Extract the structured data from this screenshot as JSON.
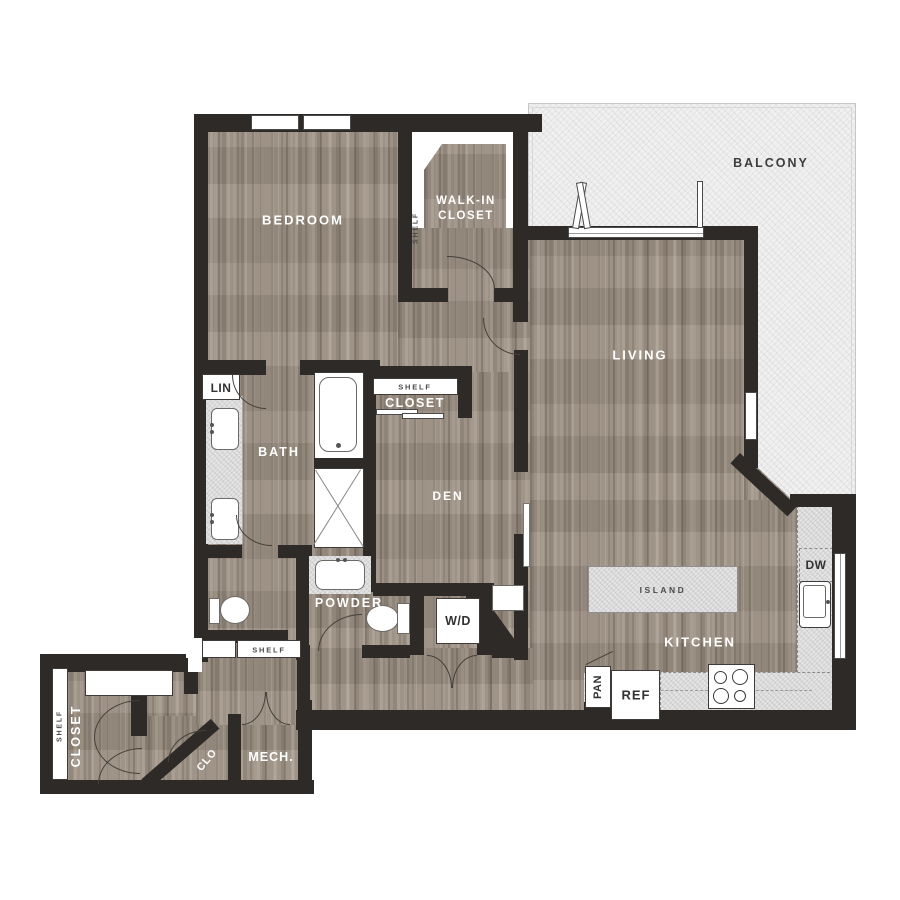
{
  "plan": {
    "rooms": {
      "bedroom": "BEDROOM",
      "walk_in_line1": "WALK-IN",
      "walk_in_line2": "CLOSET",
      "balcony": "BALCONY",
      "living": "LIVING",
      "bath": "BATH",
      "den": "DEN",
      "powder": "POWDER",
      "kitchen": "KITCHEN",
      "mech": "MECH.",
      "clo": "CLO",
      "entry_closet": "CLOSET",
      "hall_closet": "CLOSET"
    },
    "fixtures": {
      "washer_dryer": "W/D",
      "refrigerator": "REF",
      "pantry": "PAN",
      "dishwasher": "DW",
      "island": "ISLAND",
      "linen": "LIN",
      "shelf_walk_in": "SHELF",
      "shelf_hall_closet": "SHELF",
      "shelf_hallway": "SHELF",
      "shelf_entry_closet": "SHELF"
    },
    "colors": {
      "wall": "#2d2a27",
      "floor": "#9a8e81",
      "balcony": "#f0f0f0",
      "counter": "#e4e4e4",
      "label_light": "#ffffff",
      "label_dark": "#3d3d3d"
    }
  }
}
